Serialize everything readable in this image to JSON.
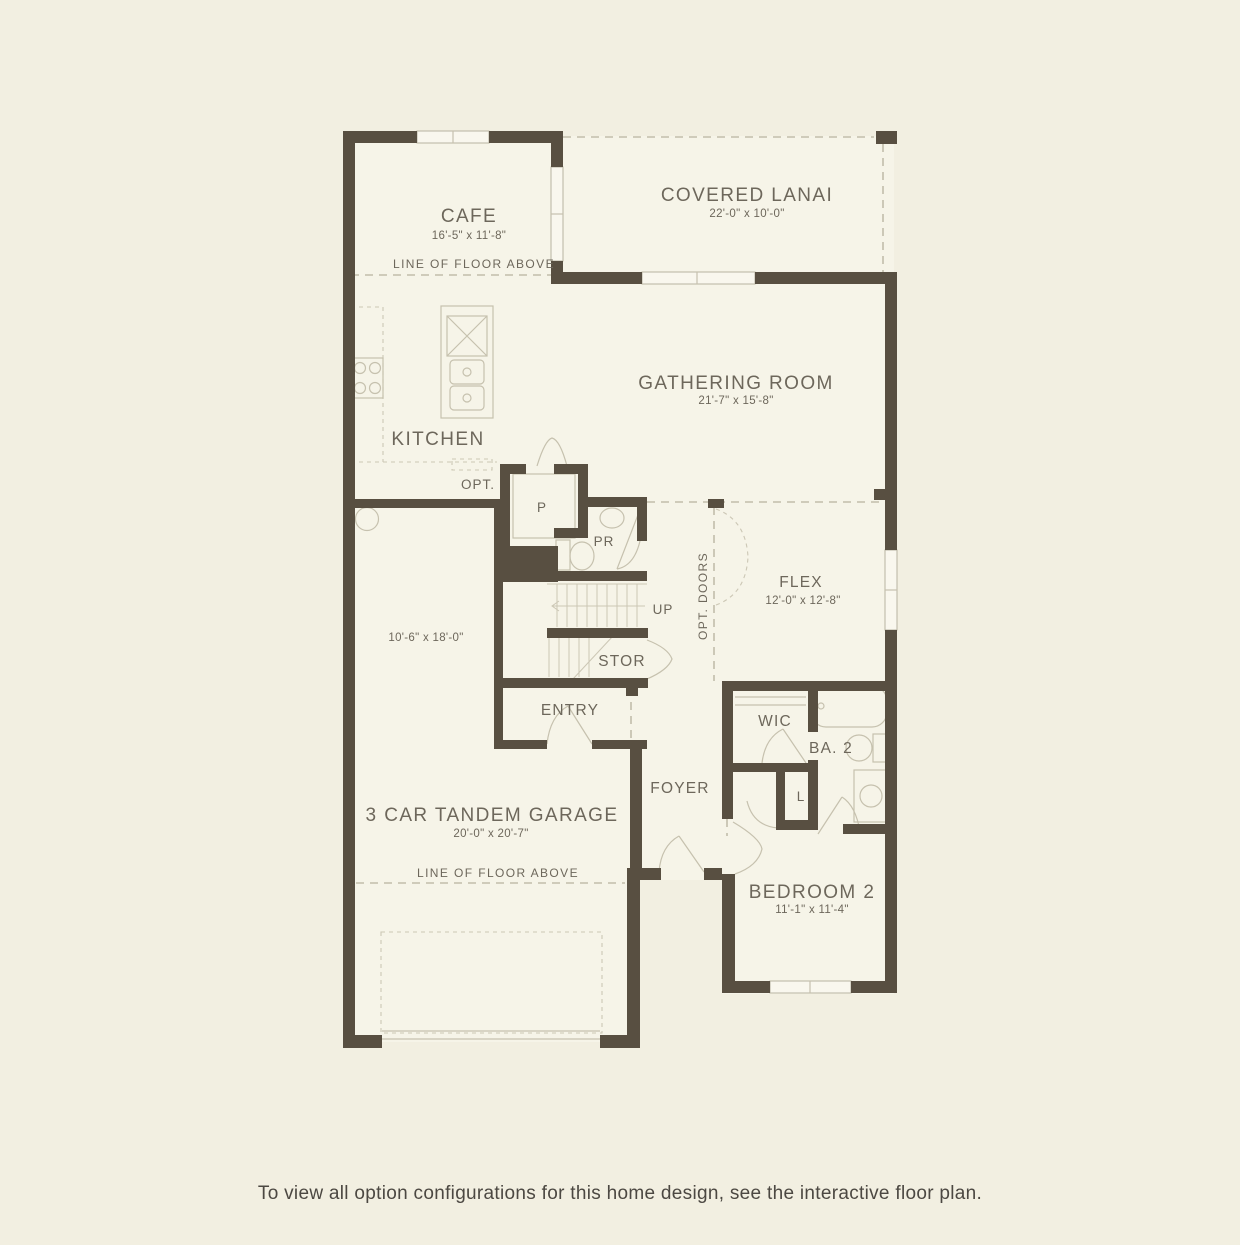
{
  "page": {
    "footer_note": "To view all option configurations for this home design, see the interactive floor plan."
  },
  "floor_plan": {
    "rooms": {
      "cafe": {
        "label": "CAFE",
        "dims": "16'-5\" x 11'-8\""
      },
      "covered_lanai": {
        "label": "COVERED LANAI",
        "dims": "22'-0\" x 10'-0\""
      },
      "gathering_room": {
        "label": "GATHERING ROOM",
        "dims": "21'-7\" x 15'-8\""
      },
      "kitchen": {
        "label": "KITCHEN"
      },
      "pantry": {
        "label": "P"
      },
      "powder_room": {
        "label": "PR"
      },
      "flex": {
        "label": "FLEX",
        "dims": "12'-0\" x 12'-8\""
      },
      "stairs": {
        "label": "UP"
      },
      "storage": {
        "label": "STOR"
      },
      "entry": {
        "label": "ENTRY"
      },
      "foyer": {
        "label": "FOYER"
      },
      "wic": {
        "label": "WIC"
      },
      "bath2": {
        "label": "BA. 2"
      },
      "laundry": {
        "label": "L"
      },
      "garage": {
        "label": "3 CAR TANDEM GARAGE",
        "dims": "20'-0\" x 20'-7\"",
        "bay_dims": "10'-6\" x 18'-0\""
      },
      "bedroom2": {
        "label": "BEDROOM 2",
        "dims": "11'-1\" x 11'-4\""
      }
    },
    "annotations": {
      "line_of_floor_above_cafe": "LINE OF FLOOR ABOVE",
      "line_of_floor_above_garage": "LINE OF FLOOR ABOVE",
      "opt_cabinets": "OPT.",
      "opt_doors": "OPT. DOORS"
    },
    "colors": {
      "page_background": "#f2efe1",
      "floor_fill": "#f6f4e8",
      "wall": "#584f41",
      "label_text": "#6d675b",
      "thin_line": "#c6c1ae",
      "footer_text": "#4c4842"
    }
  }
}
